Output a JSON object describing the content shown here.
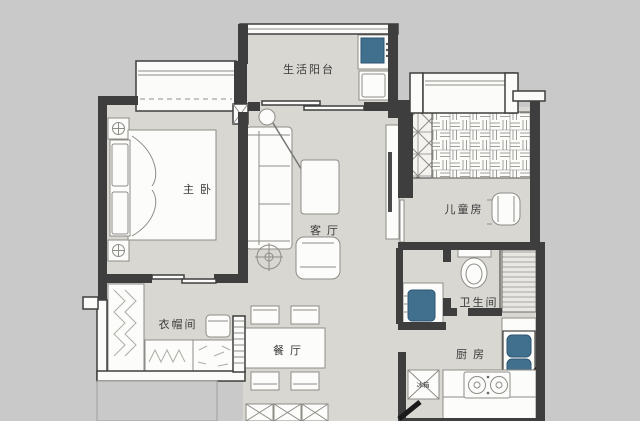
{
  "meta": {
    "type": "apartment-floor-plan",
    "width_px": 640,
    "height_px": 421
  },
  "colors": {
    "background": "#c9c9c9",
    "floor": "#d9d7d2",
    "wall": "#3e3e3e",
    "furniture_fill": "#fcfcfb",
    "furniture_stroke": "#8e8c86",
    "accent_blue": "#41708f",
    "pattern_line": "#aeaca5",
    "label": "#3a3a3a",
    "door": "#1a1a1a"
  },
  "rooms": {
    "master_bedroom": {
      "label": "主卧"
    },
    "balcony": {
      "label": "生活阳台"
    },
    "living_room": {
      "label": "客厅"
    },
    "kids_room": {
      "label": "儿童房"
    },
    "cloakroom": {
      "label": "衣帽间"
    },
    "dining_room": {
      "label": "餐厅"
    },
    "bathroom": {
      "label": "卫生间"
    },
    "kitchen": {
      "label": "厨房"
    }
  },
  "appliances": {
    "fridge_label": "冰箱"
  }
}
